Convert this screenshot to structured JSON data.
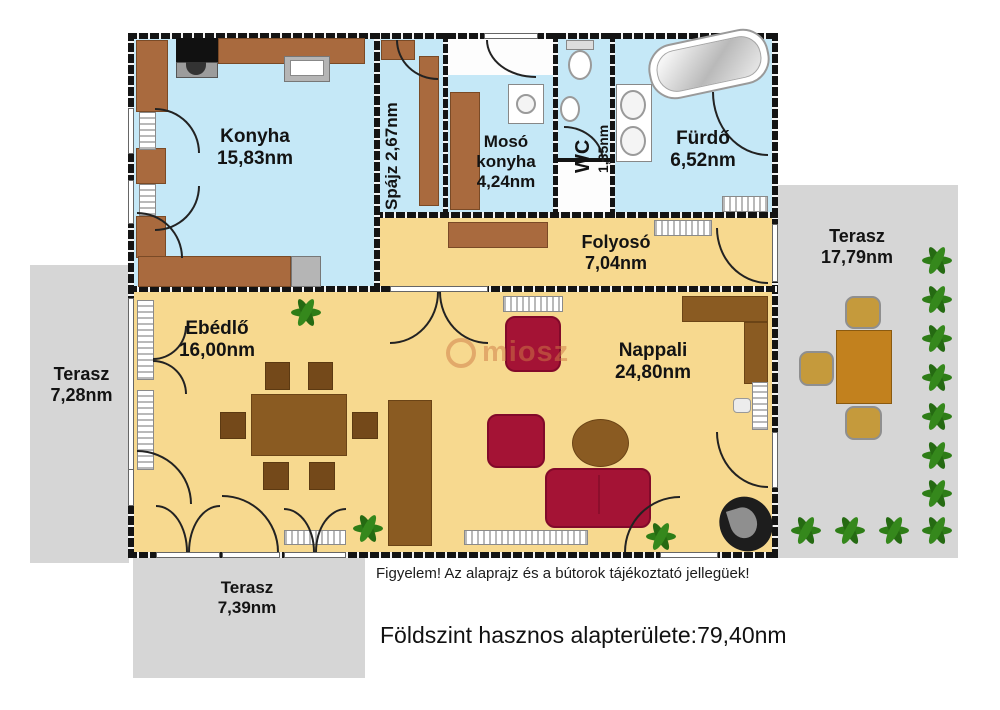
{
  "rooms": [
    {
      "name": "Konyha",
      "area": "15,83nm"
    },
    {
      "label": "Spájz 2,67nm"
    },
    {
      "lines": [
        "Mosó",
        "konyha",
        "4,24nm"
      ]
    },
    {
      "name": "WC",
      "area": "1,35nm"
    },
    {
      "name": "Fürdő",
      "area": "6,52nm"
    },
    {
      "name": "Folyosó",
      "area": "7,04nm"
    },
    {
      "name": "Ebédlő",
      "area": "16,00nm"
    },
    {
      "name": "Nappali",
      "area": "24,80nm"
    }
  ],
  "terraces": [
    {
      "name": "Terasz",
      "area": "17,79nm"
    },
    {
      "name": "Terasz",
      "area": "7,28nm"
    },
    {
      "name": "Terasz",
      "area": "7,39nm"
    }
  ],
  "watermark": {
    "text": "miosz"
  },
  "footer": {
    "disclaimer": "Figyelem! Az alaprajz és a bútorok tájékoztató jellegüek!",
    "total": "Földszint hasznos alapterülete:79,40nm"
  },
  "colors": {
    "floor_wet": "#c5e8f7",
    "floor_dry": "#f7d98f",
    "terrace": "#d6d6d6",
    "cabinet_brown": "#a96a3e",
    "furniture_brown": "#8a5b22",
    "sofa_red": "#a41335",
    "wall": "#141414"
  }
}
